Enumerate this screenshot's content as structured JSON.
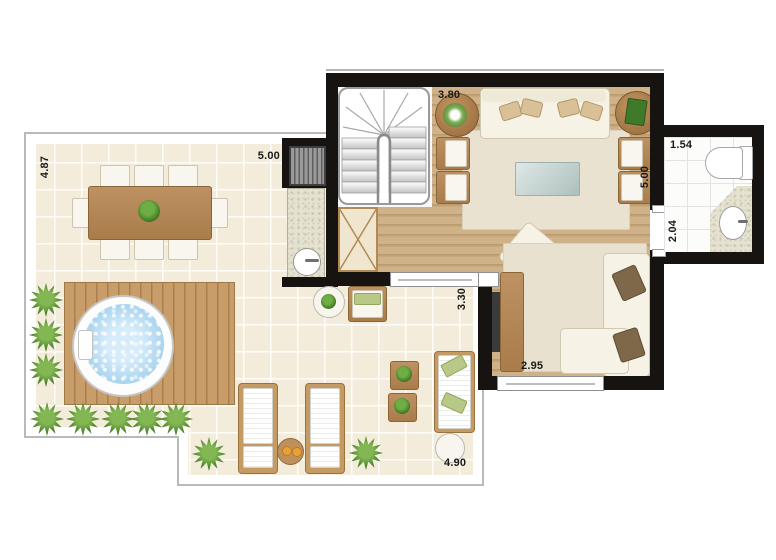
{
  "plan": {
    "type": "duplex-upper-floor-plan",
    "dimensions": {
      "terrace_depth_left": "4.87",
      "terrace_width_top": "5.00",
      "stair_hall_width": "3.80",
      "living_depth_right": "5.00",
      "bathroom_width": "1.54",
      "bathroom_depth": "2.04",
      "tv_room_depth": "3.30",
      "tv_room_width": "2.95",
      "terrace_width_bottom": "4.90"
    },
    "colors": {
      "wall": "#171310",
      "terrace_tile": "#f3ecda",
      "wood_floor": "#c9ac80",
      "deck_wood": "#c49a67",
      "spa_water": "#a9d4ee",
      "plant_green": "#3f7a27",
      "rug": "#e9e2d1",
      "granite_counter": "#e6e2d2",
      "label_text": "#1a1a1a"
    }
  }
}
